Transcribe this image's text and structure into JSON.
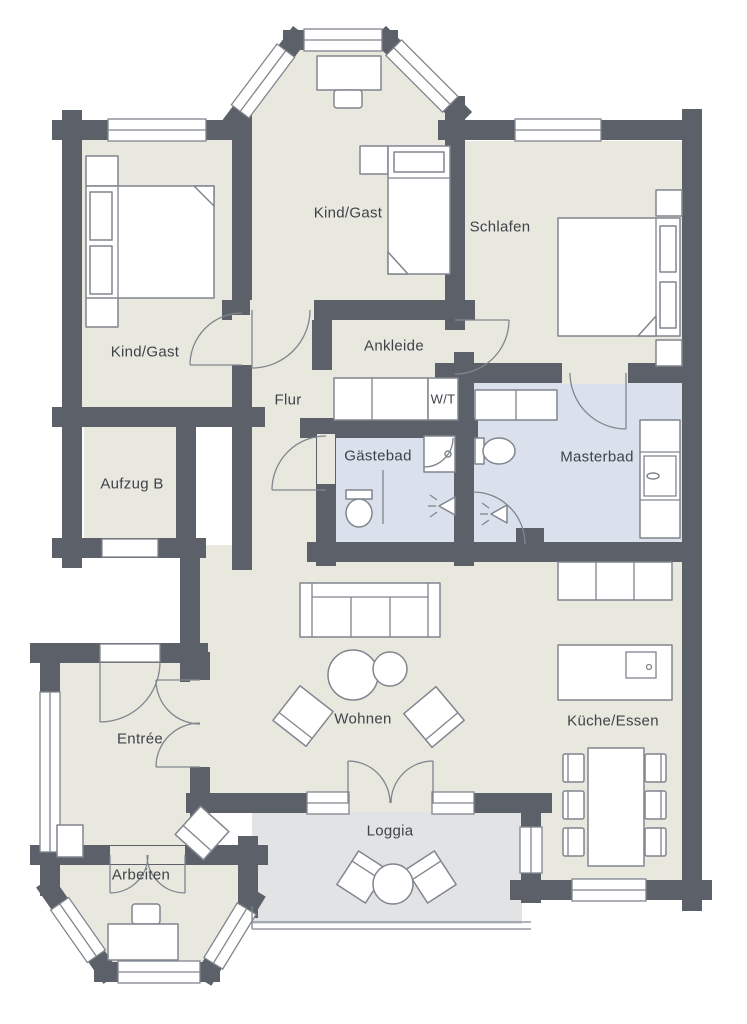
{
  "title": "Apartment floor plan",
  "palette": {
    "background": "#ffffff",
    "wall": "#5b6069",
    "floor": "#e9e8df",
    "bath_floor": "#dbe1ec",
    "loggia_floor": "#e2e3e5",
    "furniture_stroke": "#80868e",
    "label_color": "#3d4349"
  },
  "rooms": [
    {
      "id": "kind-gast-top",
      "label": "Kind/Gast",
      "x": 348,
      "y": 213
    },
    {
      "id": "schlafen",
      "label": "Schlafen",
      "x": 500,
      "y": 227
    },
    {
      "id": "kind-gast-left",
      "label": "Kind/Gast",
      "x": 145,
      "y": 352
    },
    {
      "id": "ankleide",
      "label": "Ankleide",
      "x": 394,
      "y": 346
    },
    {
      "id": "flur",
      "label": "Flur",
      "x": 288,
      "y": 400
    },
    {
      "id": "wt",
      "label": "W/T",
      "x": 443,
      "y": 399,
      "small": true
    },
    {
      "id": "gaestebad",
      "label": "Gästebad",
      "x": 378,
      "y": 456
    },
    {
      "id": "masterbad",
      "label": "Masterbad",
      "x": 597,
      "y": 457
    },
    {
      "id": "aufzug-b",
      "label": "Aufzug B",
      "x": 132,
      "y": 484
    },
    {
      "id": "entree",
      "label": "Entrée",
      "x": 140,
      "y": 739
    },
    {
      "id": "wohnen",
      "label": "Wohnen",
      "x": 363,
      "y": 719
    },
    {
      "id": "kueche-essen",
      "label": "Küche/Essen",
      "x": 613,
      "y": 721
    },
    {
      "id": "arbeiten",
      "label": "Arbeiten",
      "x": 141,
      "y": 875
    },
    {
      "id": "loggia",
      "label": "Loggia",
      "x": 390,
      "y": 831
    }
  ],
  "fixtures": [
    "double-bed",
    "single-bed",
    "double-bed",
    "desk",
    "office-chair",
    "wardrobe",
    "washer-dryer-closet",
    "shower-stall",
    "toilet",
    "toilet",
    "bathtub-vanity",
    "shower-head-icon",
    "shower-head-icon",
    "sofa",
    "coffee-tables",
    "armchair",
    "armchair",
    "kitchen-counter",
    "kitchen-island-sink",
    "dining-table",
    "dining-chairs",
    "loggia-table",
    "loggia-chairs",
    "side-table",
    "reading-chair"
  ]
}
